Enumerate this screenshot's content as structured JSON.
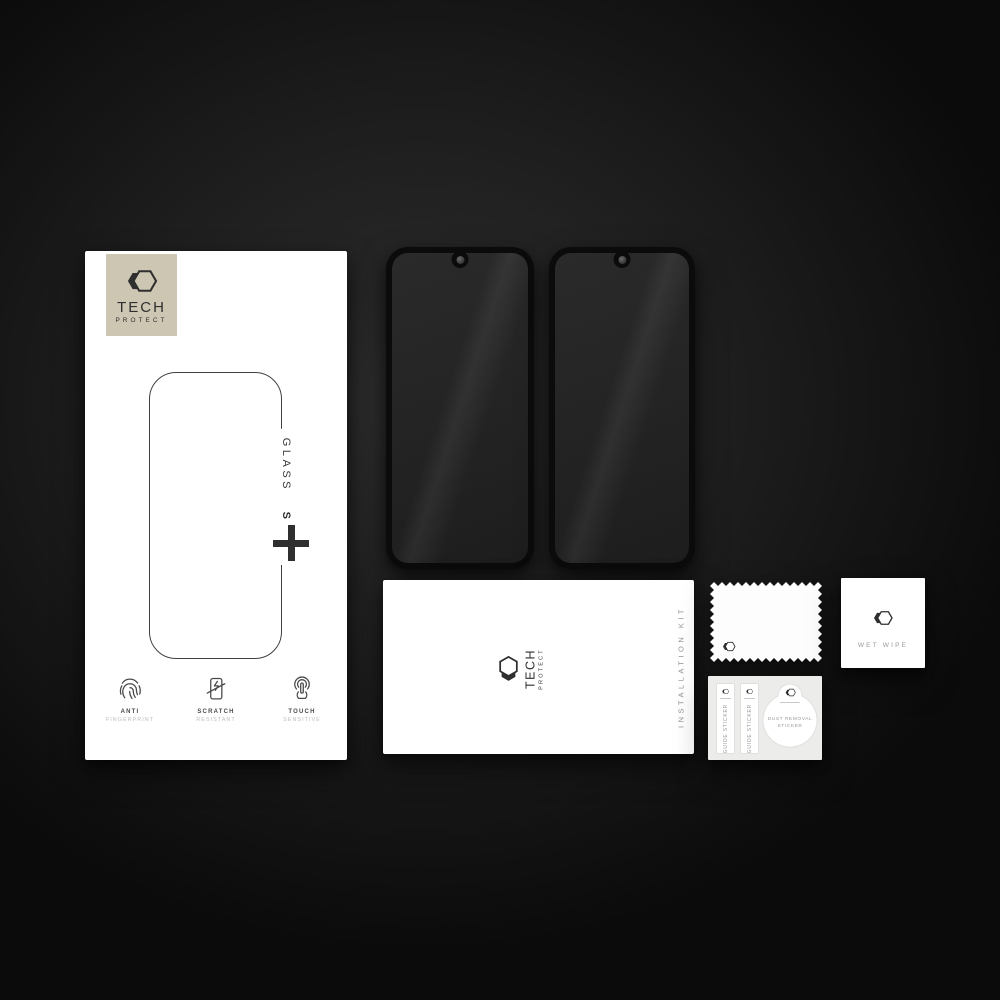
{
  "brand": {
    "tech": "TECH",
    "protect": "PROTECT"
  },
  "retail_box": {
    "product_line": "GLASS",
    "variant": "SPY",
    "features": [
      {
        "icon": "fingerprint-icon",
        "line1": "ANTI",
        "line2": "FINGERPRINT"
      },
      {
        "icon": "scratch-icon",
        "line1": "SCRATCH",
        "line2": "RESISTANT"
      },
      {
        "icon": "touch-icon",
        "line1": "TOUCH",
        "line2": "SENSITIVE"
      }
    ]
  },
  "glass_protectors": {
    "count": 2
  },
  "installation_kit": {
    "label": "INSTALLATION KIT"
  },
  "wet_wipe": {
    "label": "WET WIPE"
  },
  "sticker_sheet": {
    "guide_stickers": [
      {
        "label": "GUIDE STICKER"
      },
      {
        "label": "GUIDE STICKER"
      }
    ],
    "dust_removal": {
      "line1": "DUST REMOVAL",
      "line2": "STICKER"
    }
  },
  "colors": {
    "background_center": "#2d2d2d",
    "background_edge": "#0b0b0b",
    "surface_white": "#ffffff",
    "badge_beige": "#ccc6b2",
    "ink_dark": "#2f2f2f",
    "muted_gray": "#9a9a9a",
    "glass_frame": "#0b0b0b",
    "glass_screen": "#262626"
  }
}
